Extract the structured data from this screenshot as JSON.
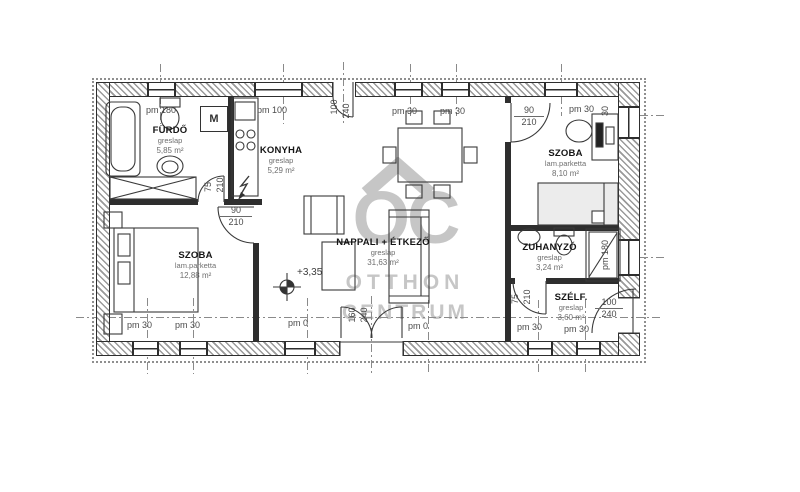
{
  "watermark": {
    "initials": "OC",
    "line1": "OTTHON",
    "line2": "CENTRUM"
  },
  "rooms": [
    {
      "name": "FÜRDŐ",
      "floor": "greslap",
      "area": "5,85 m²"
    },
    {
      "name": "KONYHA",
      "floor": "greslap",
      "area": "5,29 m²"
    },
    {
      "name": "SZOBA",
      "floor": "lam.parketta",
      "area": "12,88 m²"
    },
    {
      "name": "NAPPALI + ÉTKEZŐ",
      "floor": "greslap",
      "area": "31,63 m²"
    },
    {
      "name": "SZOBA",
      "floor": "lam.parketta",
      "area": "8,10 m²"
    },
    {
      "name": "ZUHANYZÓ",
      "floor": "greslap",
      "area": "3,24 m²"
    },
    {
      "name": "SZÉLF.",
      "floor": "greslap",
      "area": "3,60 m²"
    }
  ],
  "dims": {
    "top": [
      "pm 180",
      "pm 100",
      "pm 30",
      "pm 30",
      "pm 30"
    ],
    "side_top": "30",
    "bottom": [
      "pm 30",
      "pm 30",
      "pm 0",
      "pm 0",
      "pm 30",
      "pm 30"
    ],
    "shower_window": "pm 180"
  },
  "doors": {
    "terrace_top": {
      "w": "100",
      "h": "240"
    },
    "bathroom": {
      "w": "75",
      "h": "210"
    },
    "bedroom1": {
      "w": "90",
      "h": "210"
    },
    "bedroom2": {
      "w": "90",
      "h": "210"
    },
    "shower_room": {
      "w": "75",
      "h": "210"
    },
    "entrance": {
      "w": "100",
      "h": "240"
    },
    "terrace_bottom": {
      "w": "160",
      "h": "240"
    }
  },
  "level_marker": "+3,35",
  "appliances": {
    "washing_machine": "M"
  },
  "colors": {
    "wall": "#2e2e2e",
    "hatch": "#9a9a9a",
    "dim_text": "#4a4a4a",
    "watermark": "#b9b9b9"
  }
}
